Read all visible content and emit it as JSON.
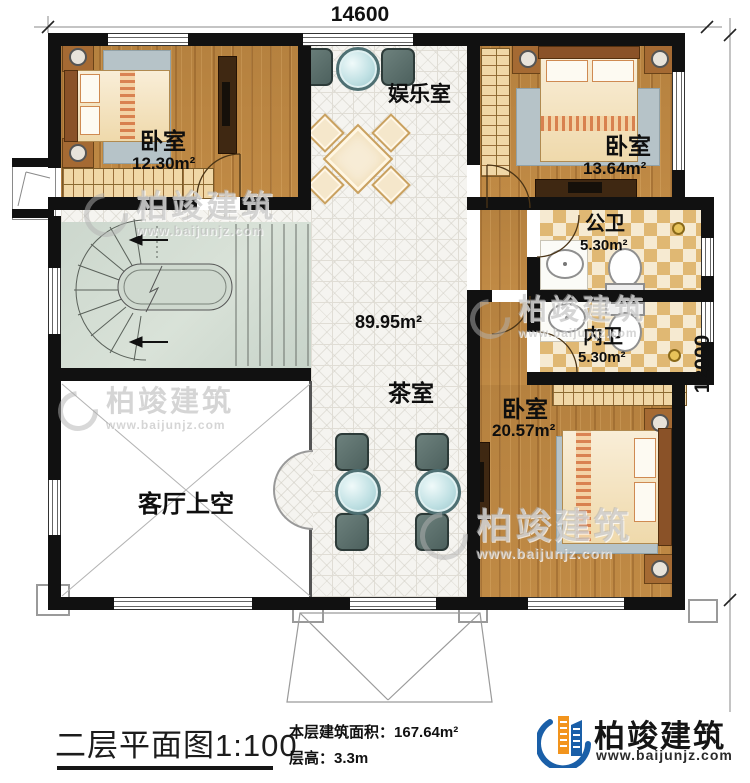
{
  "dimensions": {
    "width_mm": "14600",
    "height_mm": "12000"
  },
  "rooms": {
    "bedroom1": {
      "label": "卧室",
      "area": "12.30m²"
    },
    "entertainment": {
      "label": "娱乐室"
    },
    "bedroom2": {
      "label": "卧室",
      "area": "13.64m²"
    },
    "public_bath": {
      "label": "公卫",
      "area": "5.30m²"
    },
    "private_bath": {
      "label": "内卫",
      "area": "5.30m²"
    },
    "bedroom3": {
      "label": "卧室",
      "area": "20.57m²"
    },
    "tea_room": {
      "label": "茶室"
    },
    "living_void": {
      "label": "客厅上空"
    },
    "hall": {
      "area": "89.95m²"
    }
  },
  "footer": {
    "plan_title": "二层平面图",
    "scale": "1:100",
    "area_label": "本层建筑面积：",
    "area_value": "167.64m²",
    "height_label": "层高：",
    "height_value": "3.3m"
  },
  "brand": {
    "name": "柏竣建筑",
    "website": "www.baijunjz.com"
  },
  "watermark": {
    "name": "柏竣建筑",
    "website": "www.baijunjz.com"
  },
  "colors": {
    "wall": "#111111",
    "wood": "#b5813f",
    "tile": "#f5f4f0",
    "checker_dark": "#e0b873",
    "checker_light": "#f6ead1",
    "stair": "#ccd7cd",
    "brand_blue": "#1a5fa8",
    "brand_orange": "#f2941d"
  }
}
